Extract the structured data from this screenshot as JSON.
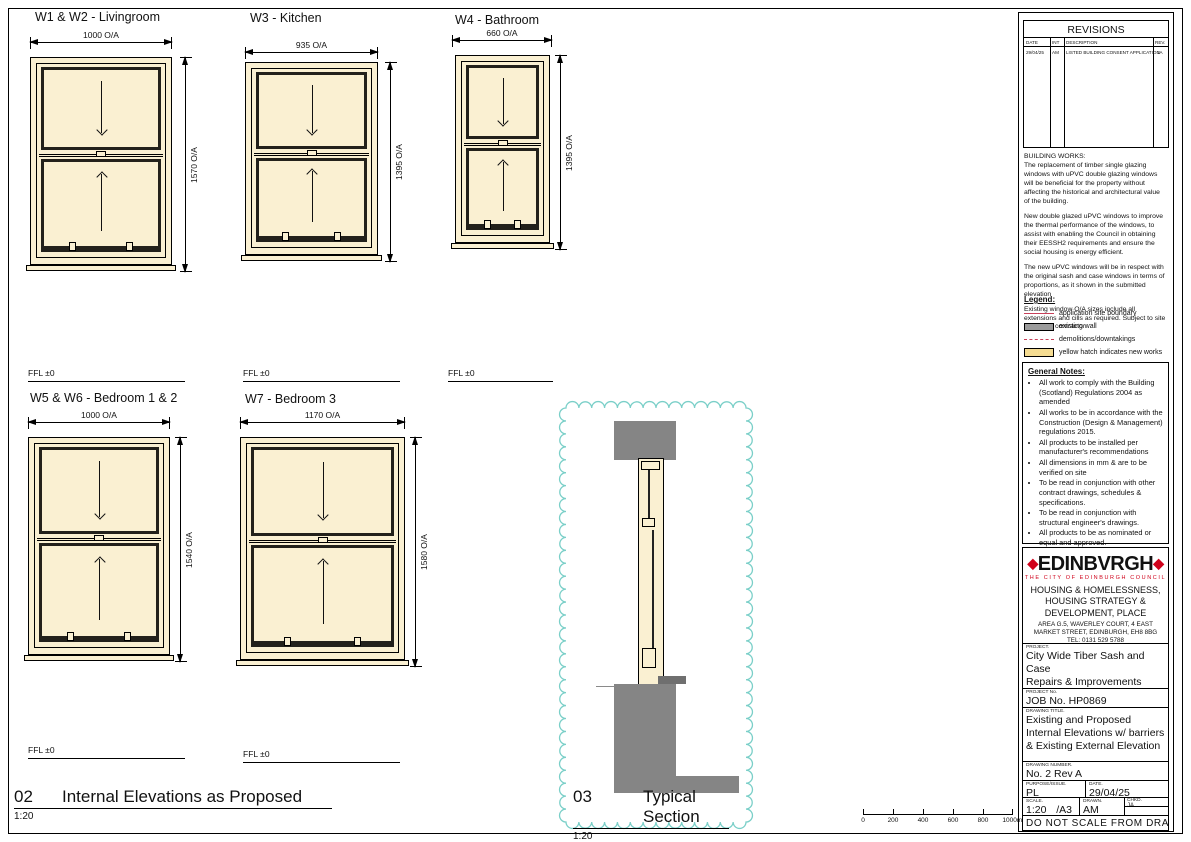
{
  "windows": [
    {
      "title": "W1 & W2 - Livingroom",
      "width_dim": "1000 O/A",
      "height_dim": "1570 O/A"
    },
    {
      "title": "W3 - Kitchen",
      "width_dim": "935 O/A",
      "height_dim": "1395 O/A"
    },
    {
      "title": "W4 - Bathroom",
      "width_dim": "660 O/A",
      "height_dim": "1395 O/A"
    },
    {
      "title": "W5 & W6 - Bedroom 1 & 2",
      "width_dim": "1000 O/A",
      "height_dim": "1540 O/A"
    },
    {
      "title": "W7 - Bedroom 3",
      "width_dim": "1170 O/A",
      "height_dim": "1580 O/A"
    }
  ],
  "ffl_label": "FFL ±0",
  "labels": {
    "elevations_number": "02",
    "elevations_title": "Internal Elevations as Proposed",
    "elevations_scale": "1:20",
    "section_number": "03",
    "section_title": "Typical Section",
    "section_scale": "1:20"
  },
  "scale_bar": {
    "ticks": [
      "0",
      "200",
      "400",
      "600",
      "800",
      "1000mm"
    ]
  },
  "revisions": {
    "title": "REVISIONS",
    "headers": {
      "date": "DATE",
      "int": "INT",
      "description": "DESCRIPTION",
      "rev": "REV."
    },
    "entry": {
      "date": "29/04/25",
      "int": "AM",
      "description": "LISTED BUILDING CONSENT APPLICATION",
      "rev": "1A"
    }
  },
  "building_works": {
    "heading": "BUILDING WORKS:",
    "p1": "The replacement of timber single glazing windows with uPVC double glazing windows will be beneficial for the property without affecting the historical and architectural value of the building.",
    "p2": "New double glazed uPVC windows to improve the thermal performance of the windows, to assist with enabling the Council in obtaining their EESSH2 requirements and ensure the social housing is energy efficient.",
    "p3": "The new uPVC windows will be in respect with the original sash and case windows in terms of proportions, as it shown in the submitted elevation",
    "p4": "Existing window O/A sizes include all extensions and cills as required. Subject to site survey by contractor."
  },
  "legend": {
    "title": "Legend:",
    "items": [
      {
        "label": "application site boundary"
      },
      {
        "label": "existing wall"
      },
      {
        "label": "demolitions/downtakings"
      },
      {
        "label": "yellow hatch indicates new works"
      }
    ]
  },
  "general_notes": {
    "title": "General Notes:",
    "items": [
      "All work to comply with the Building (Scotland) Regulations 2004 as amended",
      "All works to be in accordance with the Construction (Design & Management) regulations 2015.",
      "All products to be installed per manufacturer's recommendations",
      "All dimensions in mm & are to be verified on site",
      "To be read in conjunction with other contract drawings, schedules & specifications.",
      "To be read in conjunction with structural engineer's drawings.",
      "All products to be as nominated or equal and approved."
    ]
  },
  "council": {
    "logo_dot": "◆",
    "logo_text": "EDINBVRGH",
    "tagline": "THE CITY OF EDINBURGH COUNCIL",
    "dept_line1": "HOUSING & HOMELESSNESS,",
    "dept_line2": "HOUSING STRATEGY &",
    "dept_line3": "DEVELOPMENT, PLACE",
    "addr_line1": "AREA G.5, WAVERLEY COURT, 4 EAST",
    "addr_line2": "MARKET STREET, EDINBURGH, EH8 8BG",
    "addr_line3": "TEL: 0131 529 5788"
  },
  "title_block": {
    "project_label": "PROJECT.",
    "project_line1": "City Wide Tiber Sash and Case",
    "project_line2": "Repairs & Improvements",
    "project_line3": "2 3F2 Piershill Square East",
    "project_no_label": "PROJECT No.",
    "project_no": "JOB No. HP0869",
    "drawing_title_label": "DRAWING TITLE.",
    "drawing_title_line1": "Existing and Proposed",
    "drawing_title_line2": "Internal Elevations w/ barriers",
    "drawing_title_line3": "& Existing External Elevation",
    "drawing_number_label": "DRAWING NUMBER.",
    "drawing_number": "No. 2 Rev A",
    "purpose_label": "PURPOSE/ISSUE.",
    "purpose": "PL",
    "date_label": "DATE.",
    "date": "29/04/25",
    "scale_label": "SCALE.",
    "scale": "1:20",
    "paper": "/A3",
    "drawn_label": "DRAWN.",
    "drawn": "AM",
    "checked_label": "CHKD.",
    "checked": "JA",
    "footer": "DO NOT SCALE FROM DRAWING"
  },
  "colors": {
    "new_works_fill": "#FAF0D2",
    "legend_yellow": "#F5DC92",
    "existing_wall_gray": "#858585",
    "boundary_red": "#C8405A",
    "cloud_teal": "#7ACFC8",
    "logo_red": "#D0021B"
  }
}
